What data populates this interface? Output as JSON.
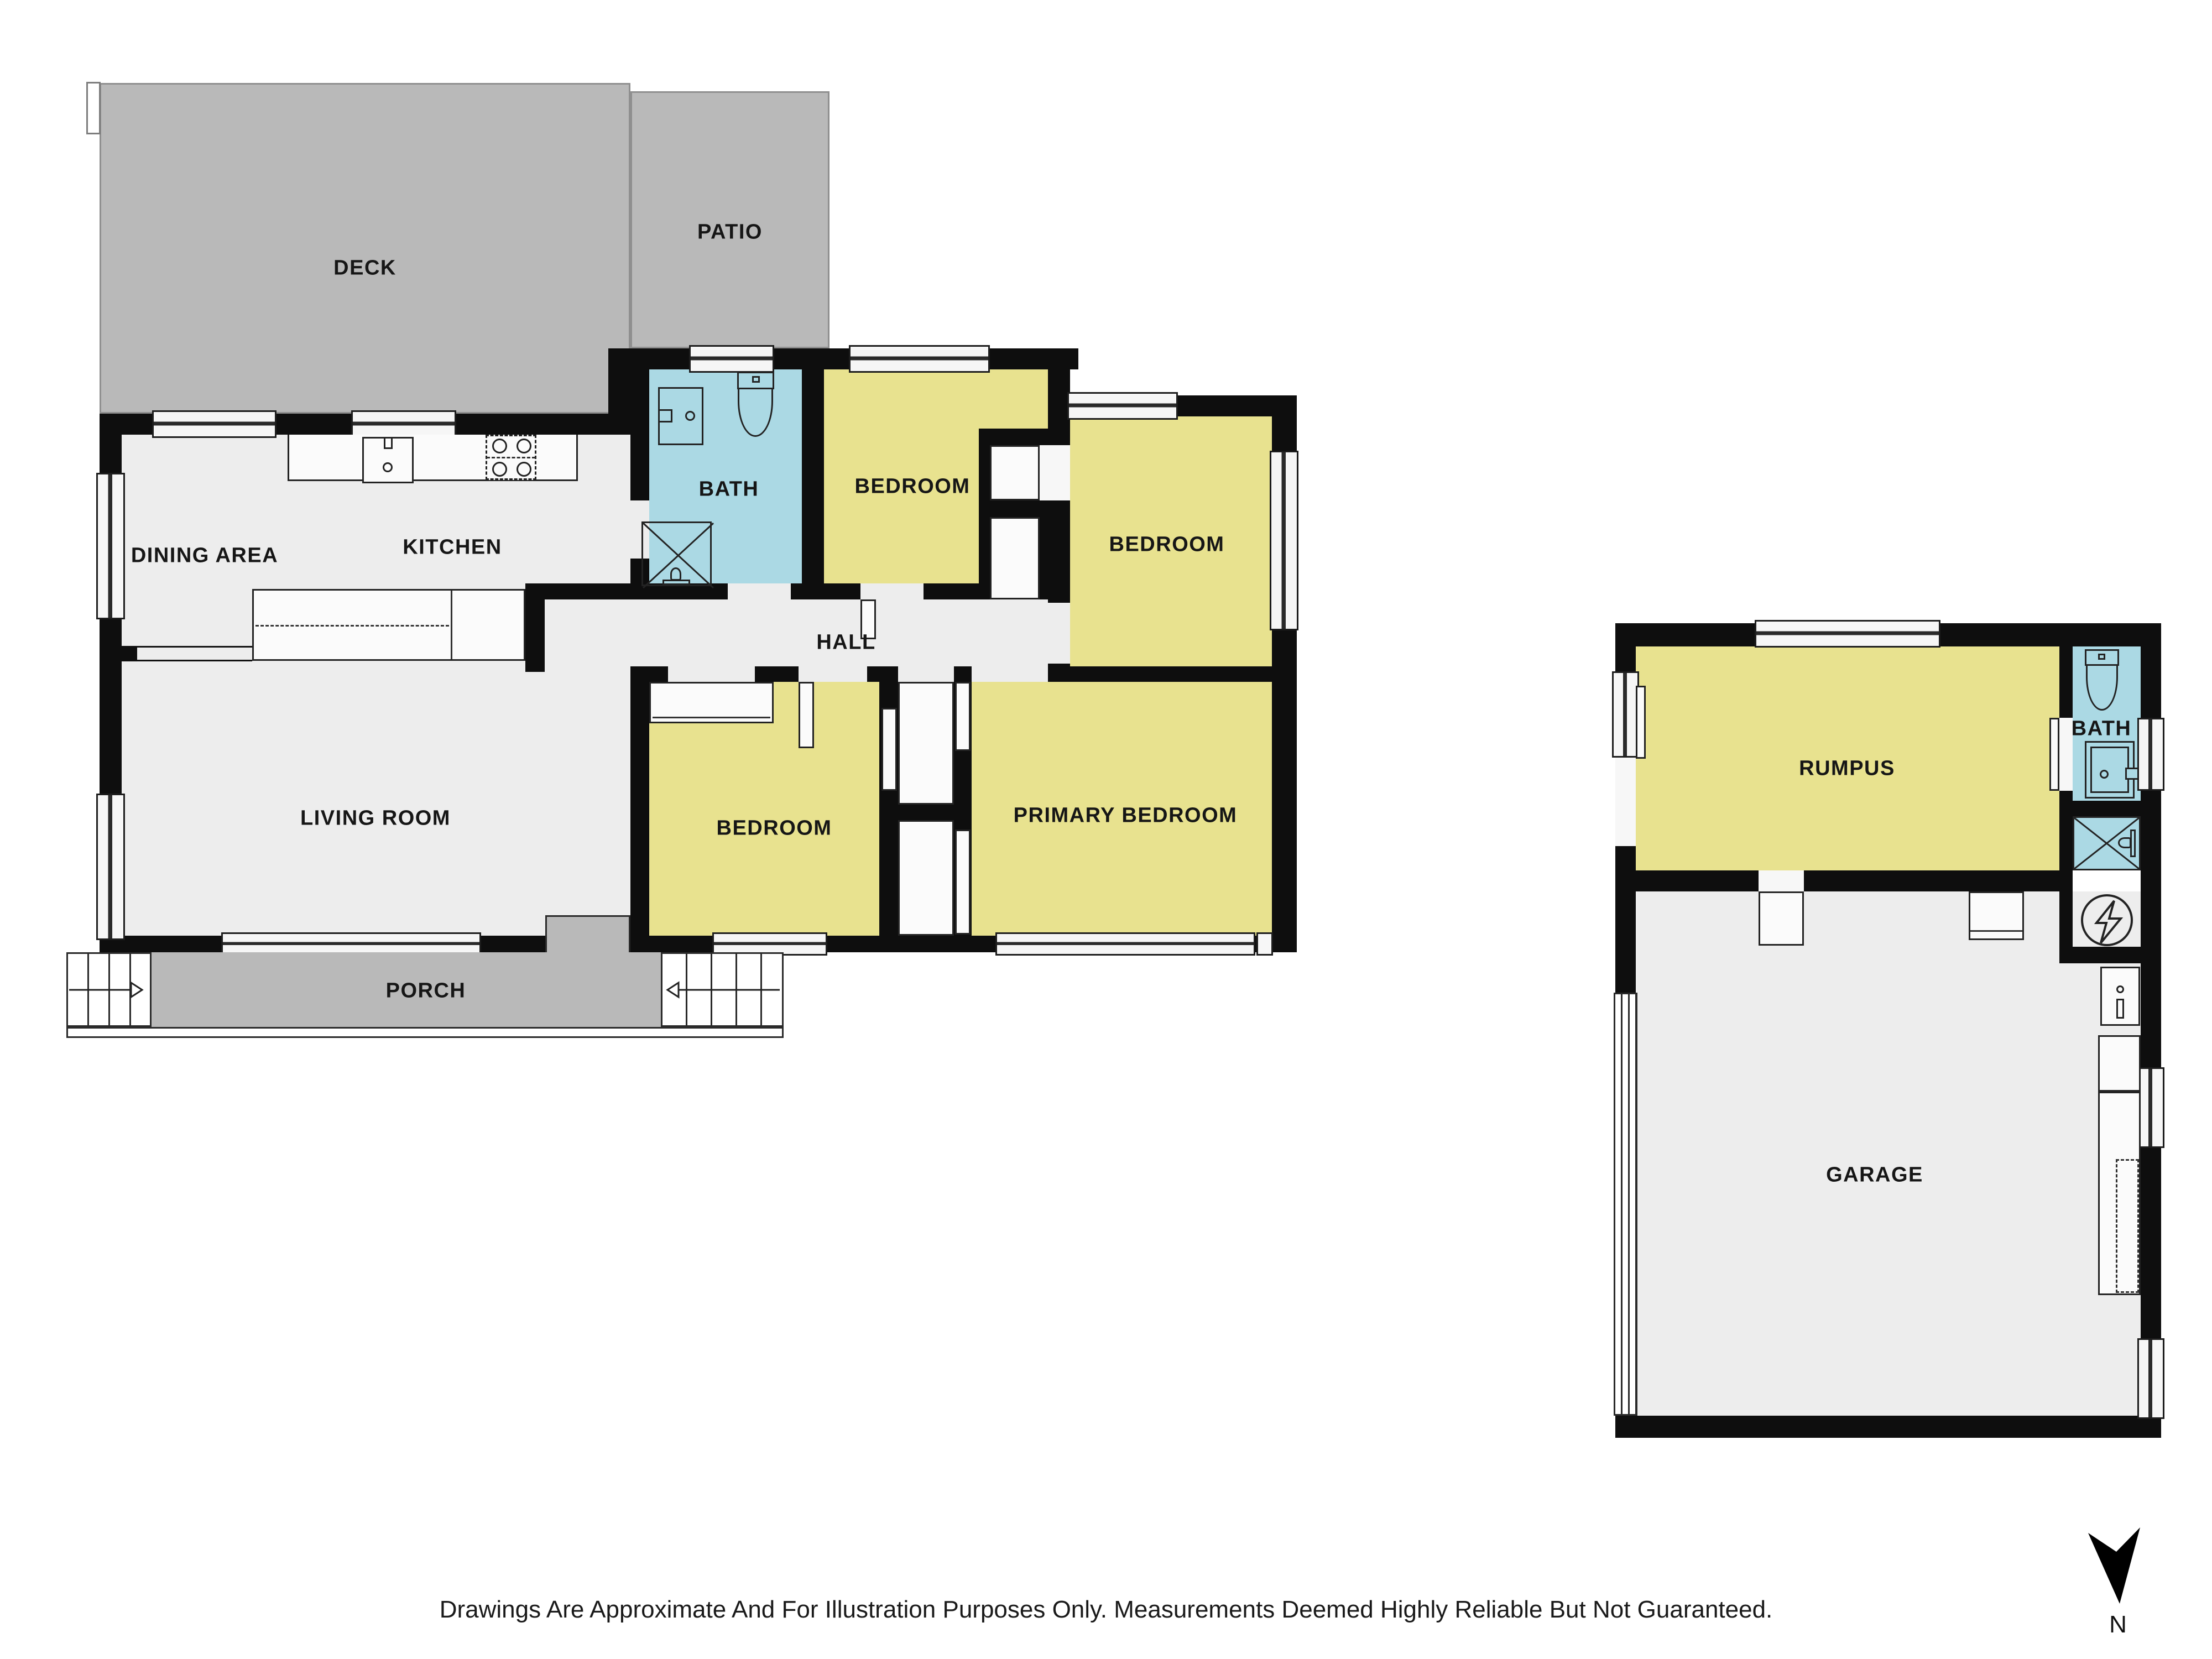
{
  "rooms": {
    "deck": {
      "label": "DECK"
    },
    "patio": {
      "label": "PATIO"
    },
    "dining": {
      "label": "DINING AREA"
    },
    "kitchen": {
      "label": "KITCHEN"
    },
    "bath": {
      "label": "BATH"
    },
    "bedroom_top": {
      "label": "BEDROOM"
    },
    "bedroom_right": {
      "label": "BEDROOM"
    },
    "hall": {
      "label": "HALL"
    },
    "living": {
      "label": "LIVING ROOM"
    },
    "bedroom_mid": {
      "label": "BEDROOM"
    },
    "primary": {
      "label": "PRIMARY BEDROOM"
    },
    "porch": {
      "label": "PORCH"
    },
    "rumpus": {
      "label": "RUMPUS"
    },
    "bath2": {
      "label": "BATH"
    },
    "garage": {
      "label": "GARAGE"
    }
  },
  "compass": {
    "north_label": "N"
  },
  "footer": {
    "disclaimer": "Drawings Are Approximate And For Illustration Purposes Only. Measurements Deemed Highly Reliable But Not Guaranteed."
  },
  "colors": {
    "room_yellow": "#e8e28f",
    "room_blue": "#abd9e4",
    "outdoor_gray": "#b9b9b9",
    "floor_gray": "#ededed",
    "wall_black": "#0e0e0e"
  },
  "icons": {
    "bath_fixtures": [
      "toilet-icon",
      "vanity-sink-icon",
      "shower-icon"
    ],
    "kitchen_fixtures": [
      "kitchen-sink-icon",
      "stove-icon",
      "island-bench-icon"
    ],
    "garage_fixtures": [
      "electrical-meter-icon",
      "laundry-tub-icon",
      "workbench-icon",
      "garage-door-icon"
    ],
    "stairs": [
      "stair-arrow-right-icon",
      "stair-arrow-left-icon"
    ],
    "compass": "north-arrow-icon"
  }
}
